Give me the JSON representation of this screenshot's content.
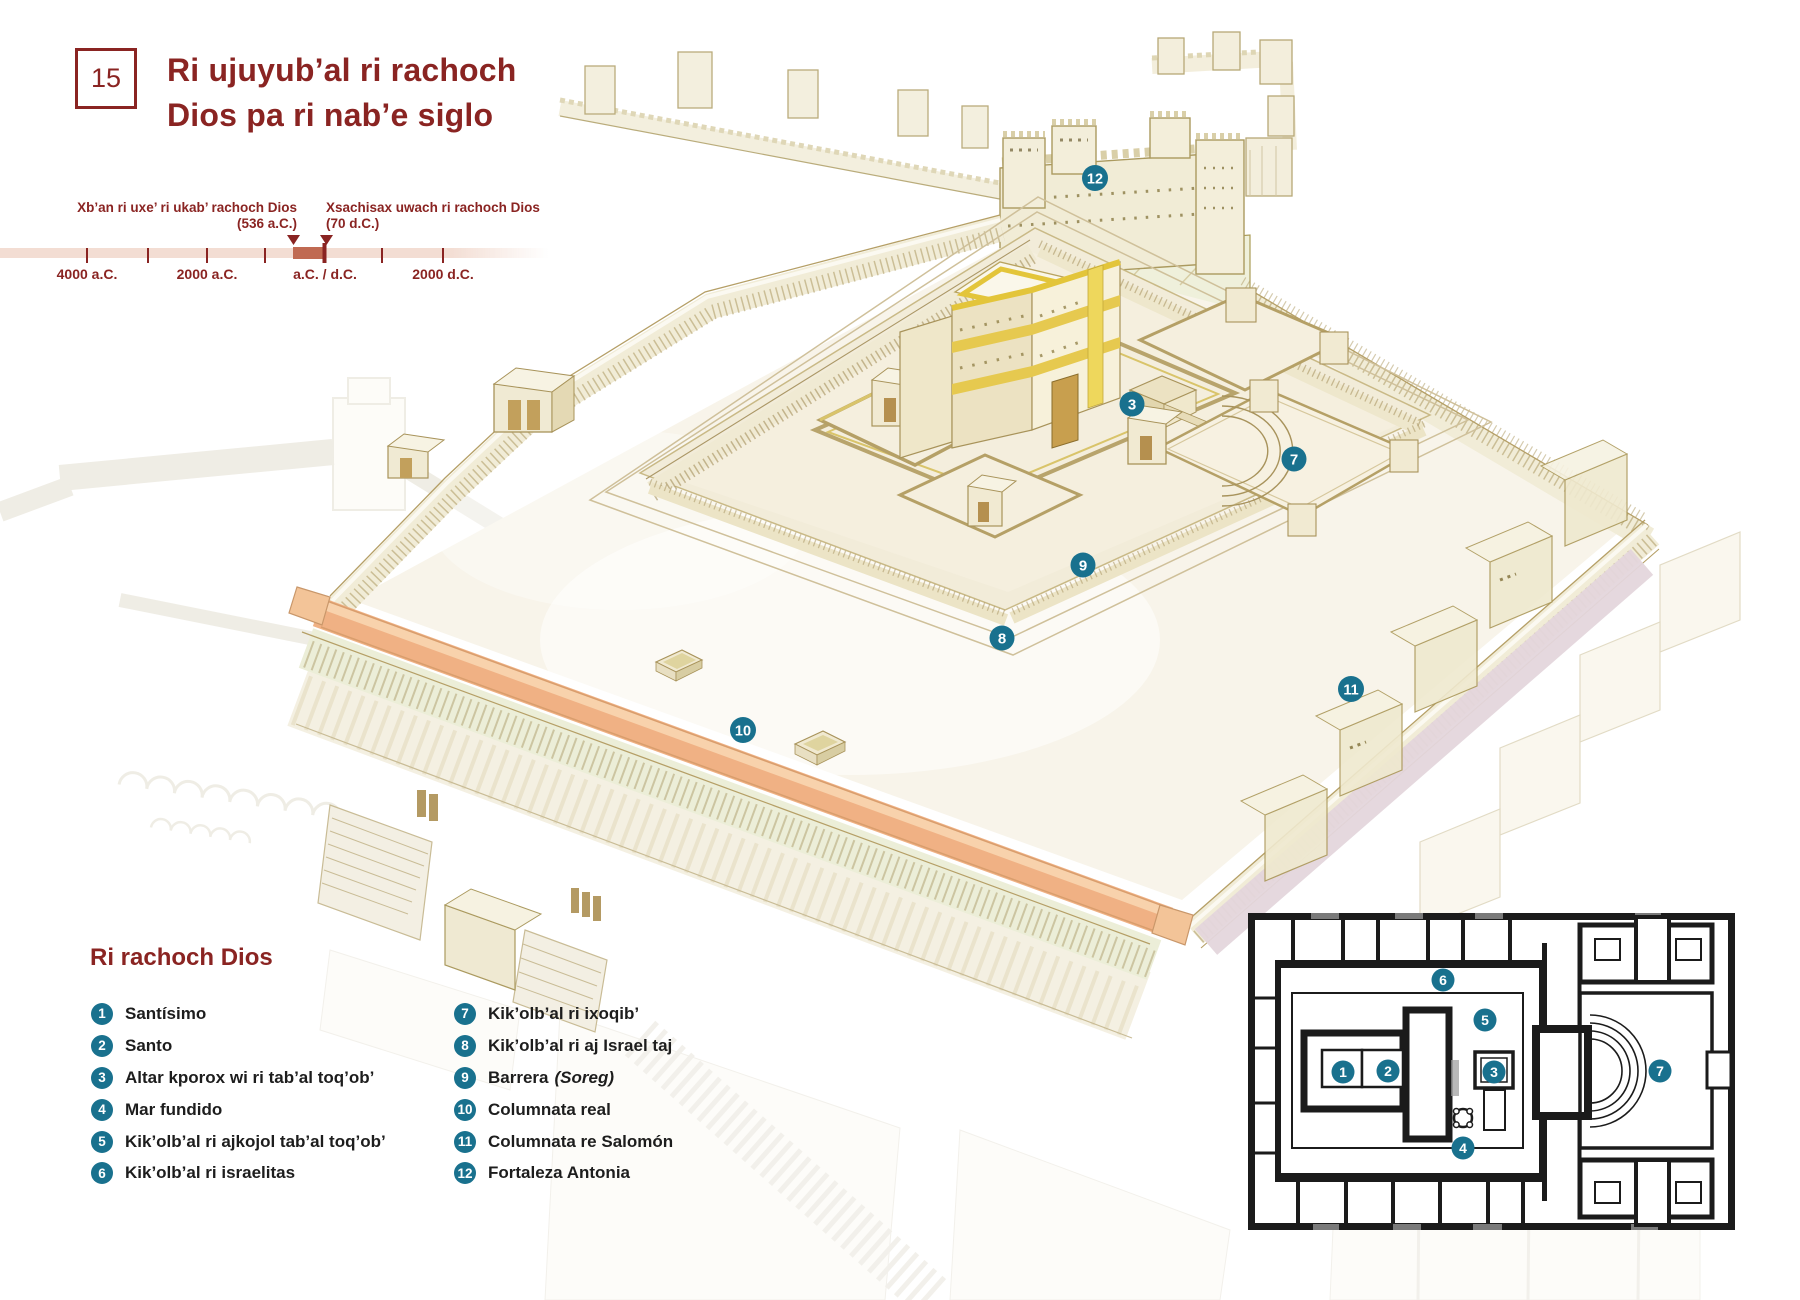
{
  "page": {
    "number": "15",
    "title_line1": "Ri ujuyub’al ri rachoch",
    "title_line2": "Dios pa ri nab’e siglo"
  },
  "timeline": {
    "event1_label": "Xb’an ri uxe’ ri ukab’ rachoch Dios",
    "event1_date": "(536 a.C.)",
    "event2_label": "Xsachisax uwach ri rachoch Dios",
    "event2_date": "(70 d.C.)",
    "tick1": "4000 a.C.",
    "tick2": "2000 a.C.",
    "tick3": "a.C. / d.C.",
    "tick4": "2000 d.C."
  },
  "legend": {
    "heading": "Ri rachoch Dios",
    "items": [
      {
        "num": "1",
        "label": "Santísimo"
      },
      {
        "num": "2",
        "label": "Santo"
      },
      {
        "num": "3",
        "label": "Altar kporox wi ri tab’al toq’ob’"
      },
      {
        "num": "4",
        "label": "Mar fundido"
      },
      {
        "num": "5",
        "label": "Kik’olb’al ri ajkojol tab’al toq’ob’"
      },
      {
        "num": "6",
        "label": "Kik’olb’al ri israelitas"
      },
      {
        "num": "7",
        "label": "Kik’olb’al ri ixoqib’"
      },
      {
        "num": "8",
        "label": "Kik’olb’al ri aj Israel taj"
      },
      {
        "num": "9",
        "label": "Barrera",
        "label_italic": "(Soreg)"
      },
      {
        "num": "10",
        "label": "Columnata real"
      },
      {
        "num": "11",
        "label": "Columnata re Salomón"
      },
      {
        "num": "12",
        "label": "Fortaleza Antonia"
      }
    ]
  },
  "illustration": {
    "badges": [
      {
        "n": "3"
      },
      {
        "n": "7"
      },
      {
        "n": "8"
      },
      {
        "n": "9"
      },
      {
        "n": "10"
      },
      {
        "n": "11"
      },
      {
        "n": "12"
      }
    ]
  },
  "plan": {
    "badges": [
      {
        "n": "1"
      },
      {
        "n": "2"
      },
      {
        "n": "3"
      },
      {
        "n": "4"
      },
      {
        "n": "5"
      },
      {
        "n": "6"
      },
      {
        "n": "7"
      }
    ]
  },
  "colors": {
    "accent_maroon": "#8a2422",
    "badge_teal": "#19718e",
    "timeline_bar": "#f3ddd3",
    "timeline_segment": "#c06a52",
    "roof_orange": "#f0b184",
    "wall_cream": "#f1ecd7",
    "gold_trim": "#e8cc3f",
    "plan_line": "#1b1b1b"
  }
}
